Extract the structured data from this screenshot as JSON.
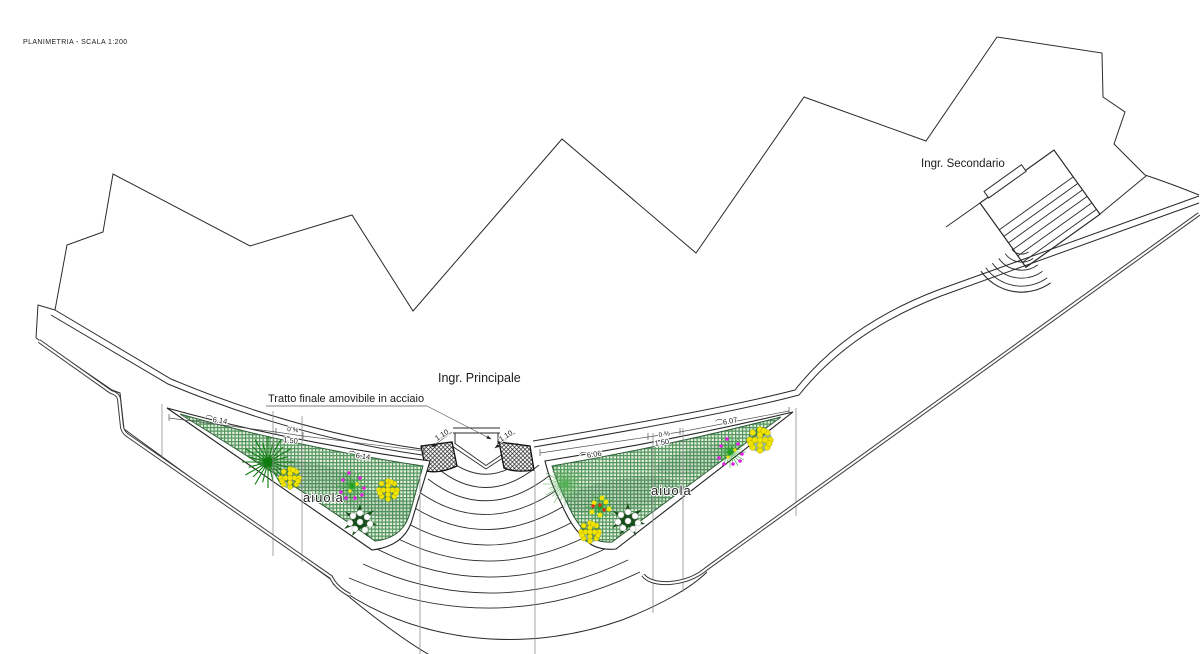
{
  "title": "PLANIMETRIA - SCALA 1:200",
  "annotations": {
    "secondary_entrance": "Ingr. Secondario",
    "main_entrance": "Ingr. Principale",
    "steel_section_note": "Tratto finale amovibile in acciaio",
    "left_flowerbed": "aiuola",
    "right_flowerbed": "aiuola"
  },
  "dimensions": {
    "arc_prefix": "⌒",
    "left_bed": {
      "segment_a": "6.14",
      "slope": "0 %",
      "strip_width": "1.50",
      "segment_b": "6.14"
    },
    "right_bed": {
      "segment_a": "6.06",
      "slope": "0 %",
      "strip_width": "1.50",
      "segment_b": "6.07"
    },
    "steel_plate_left": "1.10",
    "steel_plate_right": "1.10"
  },
  "colors": {
    "plan_line": "#2a2a2a",
    "railing": "#3a3a3a",
    "bed_base": "#e4efe0",
    "bed_grid": "#55975f",
    "bed_outline": "#2e5c38",
    "flower_yellow": "#f0e400",
    "flower_white": "#ffffff",
    "flower_magenta": "#dd22dd",
    "flower_red": "#e03018",
    "leaf_dark": "#174f1a",
    "plant_green": "#0f7c0f",
    "spray_green": "#55b055"
  }
}
